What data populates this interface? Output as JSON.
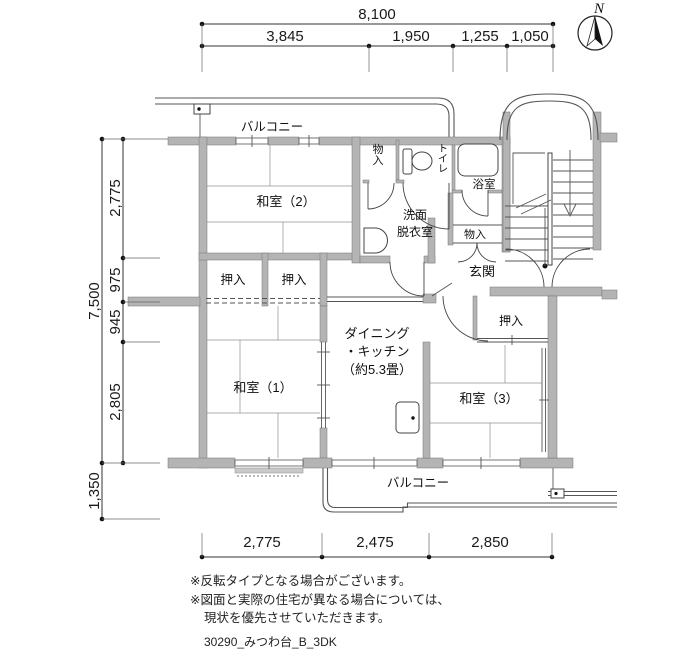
{
  "compass": {
    "north_label": "N"
  },
  "dims": {
    "top_total": "8,100",
    "top_segs": [
      "3,845",
      "1,950",
      "1,255",
      "1,050"
    ],
    "left_total": "7,500",
    "left_segs": [
      "2,775",
      "975",
      "945",
      "2,805"
    ],
    "left_balcony": "1,350",
    "bottom_segs": [
      "2,775",
      "2,475",
      "2,850"
    ]
  },
  "rooms": {
    "balcony_top": "バルコニー",
    "balcony_bottom": "バルコニー",
    "washitsu2": "和室（2）",
    "washitsu1": "和室（1）",
    "washitsu3": "和室（3）",
    "dk": [
      "ダイニング",
      "・キッチン",
      "（約5.3畳）"
    ],
    "senmen": [
      "洗面",
      "脱衣室"
    ],
    "toilet": "トイレ",
    "bath": "浴室",
    "storage_top": "物入",
    "storage_hall": "物入",
    "genkan": "玄関",
    "oshiire1": "押入",
    "oshiire2": "押入",
    "oshiire3": "押入"
  },
  "notes": {
    "line1": "※反転タイプとなる場合がございます。",
    "line2": "※図面と実際の住宅が異なる場合については、",
    "line3": "現状を優先させていただきます。",
    "plan_id": "30290_みつわ台_B_3DK"
  },
  "colors": {
    "wall": "#b4b4b4",
    "line": "#333333",
    "background": "#ffffff"
  }
}
